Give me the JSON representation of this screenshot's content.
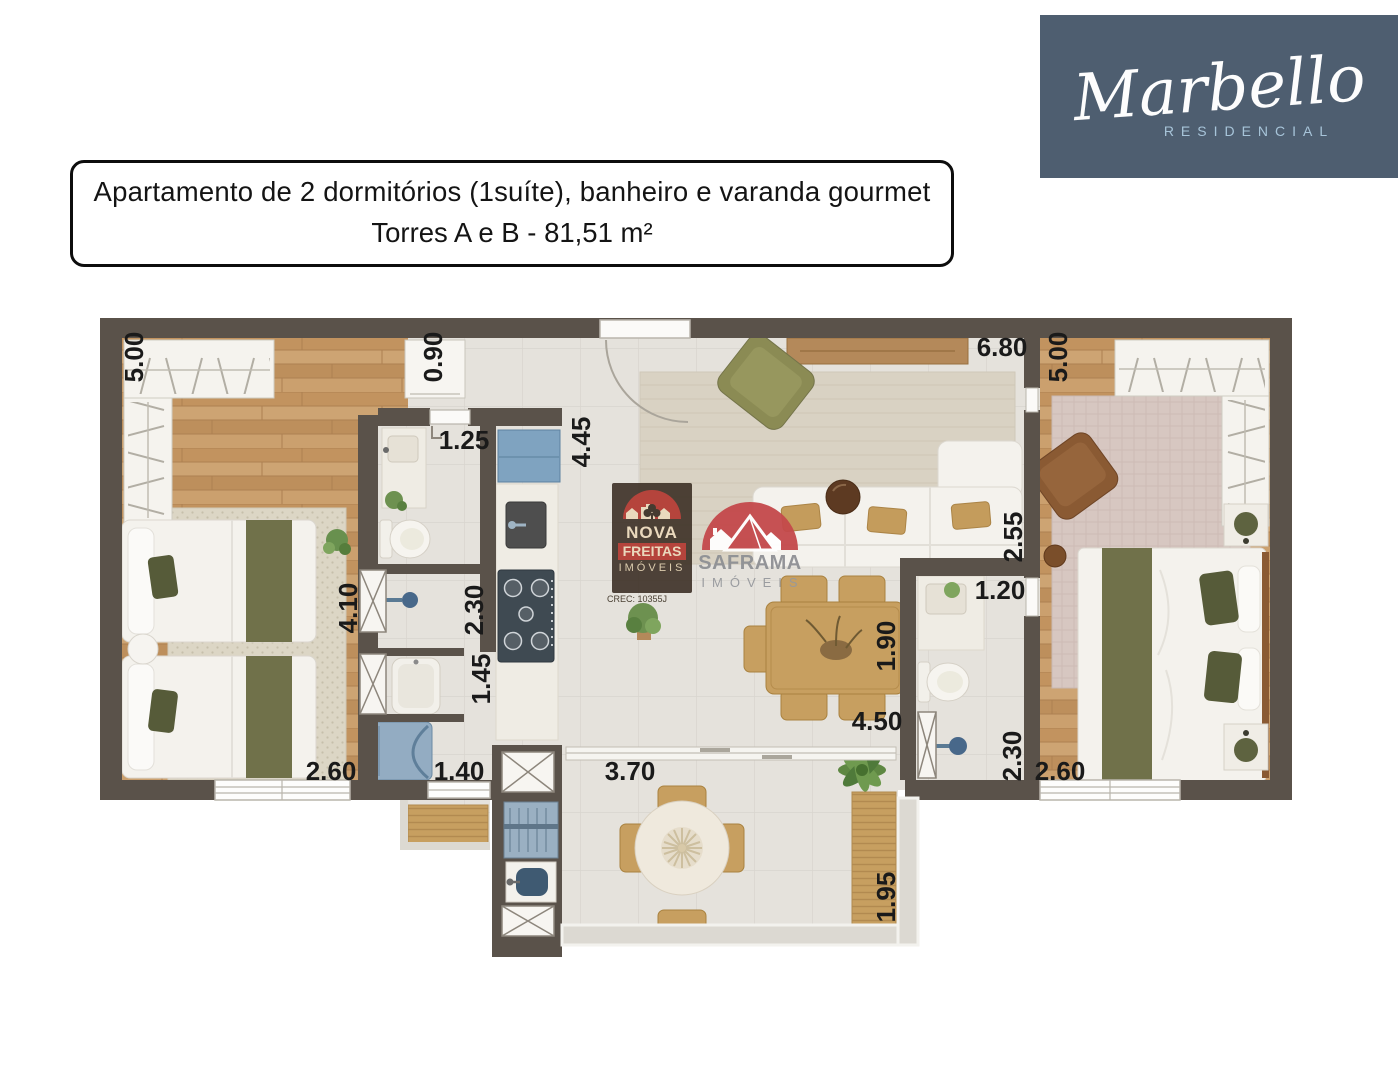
{
  "header": {
    "title_line1": "Apartamento de 2 dormitórios (1suíte), banheiro e varanda gourmet",
    "title_line2": "Torres A e B - 81,51 m²"
  },
  "logo": {
    "name": "Marbello",
    "subtitle": "RESIDENCIAL",
    "bg_color": "#4e5e70",
    "name_color": "#ffffff",
    "subtitle_color": "#a7c4d9"
  },
  "watermarks": {
    "nova_freitas": {
      "line1": "NOVA",
      "line2": "FREITAS",
      "line3": "IMÓVEIS",
      "creci": "CREC: 10355J",
      "bg_color": "#3c3026",
      "accent_red": "#b5443c",
      "cream": "#ead9bd"
    },
    "saframa": {
      "line1": "SAFRAMA",
      "line2": "IMÓVEIS",
      "accent_red": "#c4494b",
      "text_gray": "#8e9094"
    }
  },
  "floor_plan": {
    "wall_color": "#5a524a",
    "wood_color": "#c79d6a",
    "tile_color": "#e5e2dc",
    "accent_olive": "#70714a",
    "accent_tan": "#c79f60",
    "accent_blue": "#8aa7bf",
    "dimensions": [
      {
        "id": "bedroom1-width-top",
        "value": "5.00"
      },
      {
        "id": "hall-width",
        "value": "0.90"
      },
      {
        "id": "bathroom-door-width",
        "value": "1.25"
      },
      {
        "id": "kitchen-living-length",
        "value": "4.45"
      },
      {
        "id": "living-width-top",
        "value": "6.80"
      },
      {
        "id": "suite-width-top",
        "value": "5.00"
      },
      {
        "id": "living-depth",
        "value": "2.55"
      },
      {
        "id": "bedroom1-length",
        "value": "4.10"
      },
      {
        "id": "bathroom-shower-length",
        "value": "2.30"
      },
      {
        "id": "dining-depth",
        "value": "1.90"
      },
      {
        "id": "suite-bath-width",
        "value": "1.20"
      },
      {
        "id": "corridor-length",
        "value": "1.45"
      },
      {
        "id": "dining-width",
        "value": "4.50"
      },
      {
        "id": "suite-shower-length",
        "value": "2.30"
      },
      {
        "id": "suite-width-bottom",
        "value": "2.60"
      },
      {
        "id": "bedroom1-width-bottom",
        "value": "2.60"
      },
      {
        "id": "laundry-width",
        "value": "1.40"
      },
      {
        "id": "varanda-width",
        "value": "3.70"
      },
      {
        "id": "varanda-depth",
        "value": "1.95"
      }
    ]
  }
}
